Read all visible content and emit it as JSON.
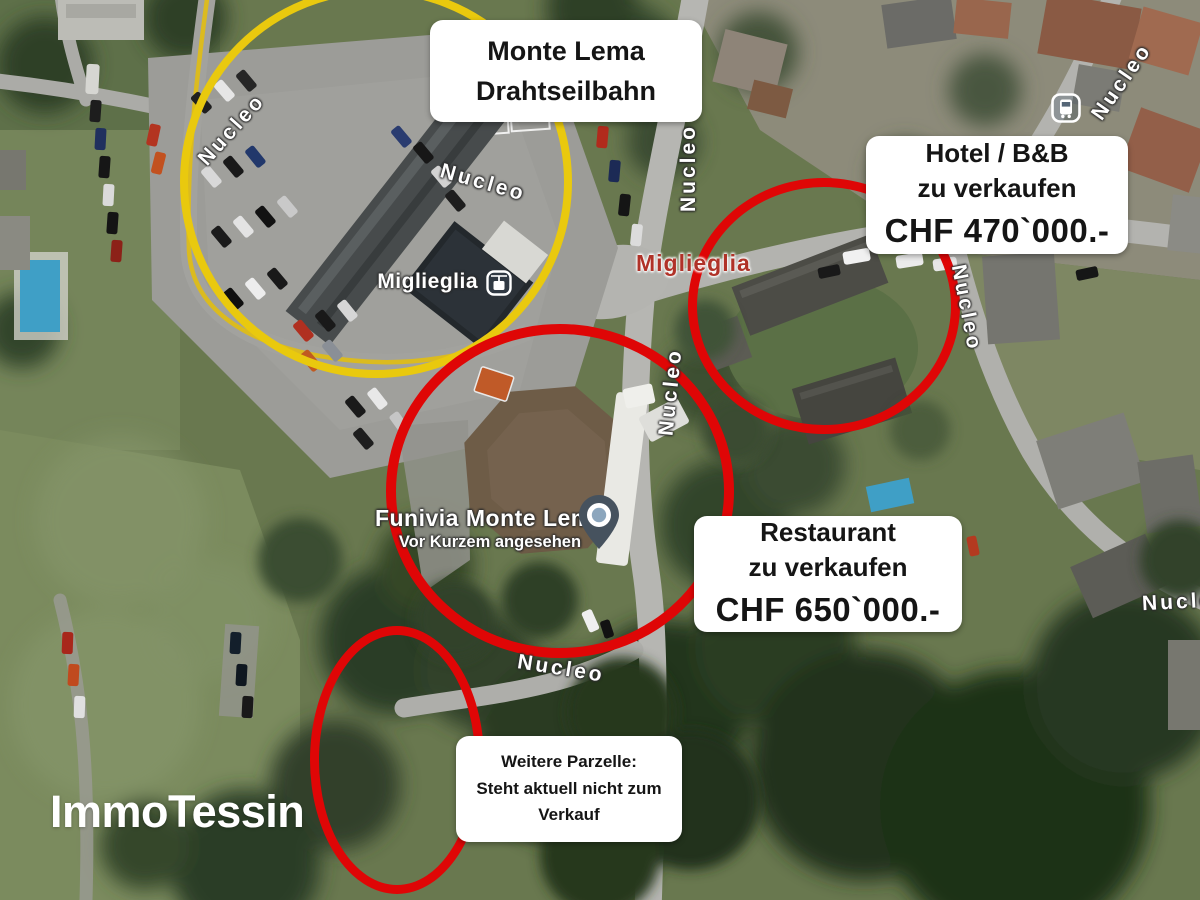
{
  "map": {
    "street_name": "Nucleo",
    "town_label": "Miglieglia",
    "station_label": "Miglieglia",
    "poi": {
      "title": "Funivia Monte Lema",
      "subtitle": "Vor Kurzem angesehen"
    },
    "icons": {
      "bus_stop": "bus-stop-icon",
      "gondola": "gondola-icon",
      "pin": "map-pin-icon"
    }
  },
  "annotations": {
    "cable_car": {
      "line1": "Monte Lema",
      "line2": "Drahtseilbahn"
    },
    "hotel": {
      "line1": "Hotel / B&B",
      "line2": "zu verkaufen",
      "price": "CHF 470`000.-"
    },
    "restaurant": {
      "line1": "Restaurant",
      "line2": "zu verkaufen",
      "price": "CHF 650`000.-"
    },
    "parcel": {
      "line1": "Weitere Parzelle:",
      "line2": "Steht aktuell nicht zum",
      "line3": "Verkauf"
    }
  },
  "branding": {
    "logo": "ImmoTessin"
  },
  "colors": {
    "highlight_yellow": "#e9c90e",
    "highlight_red": "#df0606",
    "note_background": "#ffffff",
    "note_text": "#151515",
    "town_label_red": "#b03228",
    "street_label_white": "#ffffff"
  }
}
